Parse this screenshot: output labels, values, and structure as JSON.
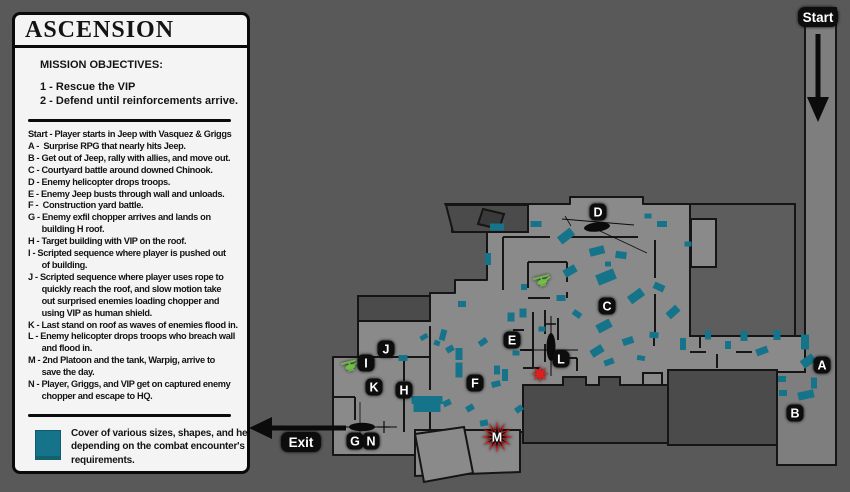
{
  "panel": {
    "title": "ASCENSION",
    "objectives_heading": "MISSION OBJECTIVES:",
    "objectives": [
      "1 - Rescue the VIP",
      "2 - Defend until reinforcements arrive."
    ],
    "mission_lines": [
      {
        "text": "Start - Player starts in Jeep with Vasquez & Griggs",
        "indent": 0
      },
      {
        "text": "A -  Surprise RPG that nearly hits Jeep.",
        "indent": 0
      },
      {
        "text": "B - Get out of Jeep, rally with allies, and move out.",
        "indent": 0
      },
      {
        "text": "C - Courtyard battle around downed Chinook.",
        "indent": 0
      },
      {
        "text": "D - Enemy helicopter drops troops.",
        "indent": 0
      },
      {
        "text": "E - Enemy Jeep busts through wall and unloads.",
        "indent": 0
      },
      {
        "text": "F -  Construction yard battle.",
        "indent": 0
      },
      {
        "text": "G - Enemy exfil chopper arrives and lands on",
        "indent": 0
      },
      {
        "text": "building H roof.",
        "indent": 1
      },
      {
        "text": "H - Target building with VIP on the roof.",
        "indent": 0
      },
      {
        "text": "I - Scripted sequence where player is pushed out",
        "indent": 0
      },
      {
        "text": "of building.",
        "indent": 1
      },
      {
        "text": "J - Scripted sequence where player uses rope to",
        "indent": 0
      },
      {
        "text": "quickly reach the roof, and slow motion take",
        "indent": 1
      },
      {
        "text": "out surprised enemies loading chopper and",
        "indent": 1
      },
      {
        "text": "using VIP as human shield.",
        "indent": 1
      },
      {
        "text": "K - Last stand on roof as waves of enemies flood in.",
        "indent": 0
      },
      {
        "text": "L - Enemy helicopter drops troops who breach wall",
        "indent": 0
      },
      {
        "text": "and flood in.",
        "indent": 1
      },
      {
        "text": "M - 2nd Platoon and the tank, Warpig, arrive to",
        "indent": 0
      },
      {
        "text": "save the day.",
        "indent": 1
      },
      {
        "text": "N - Player, Griggs, and VIP get on captured enemy",
        "indent": 0
      },
      {
        "text": "chopper and escape to HQ.",
        "indent": 1
      }
    ],
    "legend_note_lines": [
      "Cover of various sizes, shapes, and heights",
      "depending on the combat encounter's",
      "requirements."
    ],
    "legend_swatch_color": "#15748a"
  },
  "map": {
    "colors": {
      "bg": "#595959",
      "ground": "#8a8a8a",
      "road": "#7e7e7e",
      "cover": "#15748a",
      "dark_building": "#4b4b4b",
      "mid_building": "#5d5d5d",
      "darkest": "#3a3a3a",
      "wall": "#161616",
      "outline": "#151515",
      "marker_bg": "#0c0c0c",
      "marker_text": "#ffffff",
      "star_red": "#e51c1c",
      "heli_green": "#6fbe44",
      "heli_black": "#0b0b0b"
    },
    "road": {
      "pts": "805,8 836,8 836,465 777,465 777,372 805,372"
    },
    "ground": {
      "pts": "445,204 570,204 570,197 643,197 643,204 795,204 795,336 805,336 805,372 668,372 668,385 523,385 523,432 430,432 430,455 333,455 333,357 358,357 358,296 430,296 430,293 455,293 455,280 487,280 487,232 452,232 452,204"
    },
    "protrusion": {
      "pts": "415,430 520,430 520,472 415,476"
    },
    "tilted_square": {
      "pts": "415,434 464,427 473,473 424,482"
    },
    "buildings": [
      {
        "name": "building-top-band",
        "pts": "446,205 528,205 528,232 453,232",
        "fill": "dark"
      },
      {
        "name": "building-ramp",
        "pts": "483,209 504,214 499,229 478,224",
        "fill": "darkest"
      },
      {
        "name": "building-right-block",
        "pts": "690,204 795,204 795,336 690,336",
        "fill": "mid"
      },
      {
        "name": "building-right-room",
        "pts": "691,219 716,219 716,267 691,267",
        "fill": "ground"
      },
      {
        "name": "building-bottom-right",
        "pts": "668,370 777,370 777,445 668,445",
        "fill": "dark"
      },
      {
        "name": "building-bottom-center",
        "pts": "523,385 563,385 563,377 586,377 586,385 599,385 599,377 620,377 620,385 668,385 668,443 523,443",
        "fill": "dark"
      },
      {
        "name": "building-above-j",
        "pts": "358,296 430,296 430,321 358,321",
        "fill": "dark"
      },
      {
        "name": "small-room-passage",
        "pts": "643,373 662,373 662,385 643,385",
        "fill": "ground"
      }
    ],
    "walls": [
      [
        503,
        237,
        550,
        237
      ],
      [
        568,
        237,
        638,
        237
      ],
      [
        503,
        237,
        503,
        290
      ],
      [
        655,
        240,
        655,
        278
      ],
      [
        655,
        294,
        655,
        332
      ],
      [
        528,
        262,
        567,
        262
      ],
      [
        567,
        262,
        567,
        282
      ],
      [
        567,
        292,
        567,
        298
      ],
      [
        528,
        298,
        550,
        298
      ],
      [
        528,
        262,
        528,
        288
      ],
      [
        533,
        312,
        533,
        368
      ],
      [
        545,
        310,
        545,
        334
      ],
      [
        545,
        344,
        545,
        362
      ],
      [
        520,
        350,
        533,
        350
      ],
      [
        513,
        330,
        524,
        330
      ],
      [
        558,
        318,
        558,
        340
      ],
      [
        558,
        358,
        577,
        358
      ],
      [
        577,
        358,
        577,
        371
      ],
      [
        523,
        368,
        540,
        368
      ],
      [
        654,
        336,
        654,
        346
      ],
      [
        700,
        336,
        700,
        348
      ],
      [
        717,
        354,
        717,
        368
      ],
      [
        690,
        352,
        706,
        352
      ],
      [
        736,
        352,
        752,
        352
      ],
      [
        404,
        357,
        404,
        381
      ],
      [
        404,
        397,
        404,
        432
      ],
      [
        430,
        300,
        430,
        316
      ],
      [
        430,
        326,
        430,
        390
      ],
      [
        430,
        400,
        430,
        430
      ],
      [
        358,
        357,
        430,
        357
      ],
      [
        333,
        397,
        355,
        397
      ],
      [
        355,
        397,
        355,
        420
      ]
    ],
    "covers": [
      [
        497,
        227,
        14,
        7,
        0
      ],
      [
        536,
        224,
        11,
        6,
        0
      ],
      [
        566,
        236,
        16,
        9,
        -38
      ],
      [
        597,
        251,
        15,
        8,
        -14
      ],
      [
        621,
        255,
        11,
        7,
        8
      ],
      [
        662,
        224,
        10,
        6,
        0
      ],
      [
        648,
        216,
        7,
        5,
        0
      ],
      [
        688,
        244,
        7,
        5,
        0
      ],
      [
        570,
        271,
        13,
        8,
        -30
      ],
      [
        606,
        277,
        19,
        11,
        -22
      ],
      [
        636,
        296,
        16,
        9,
        -36
      ],
      [
        659,
        287,
        11,
        7,
        25
      ],
      [
        673,
        312,
        13,
        8,
        -42
      ],
      [
        604,
        326,
        15,
        9,
        -28
      ],
      [
        577,
        314,
        9,
        6,
        35
      ],
      [
        628,
        341,
        11,
        7,
        -18
      ],
      [
        654,
        335,
        9,
        6,
        5
      ],
      [
        597,
        351,
        13,
        8,
        -32
      ],
      [
        561,
        298,
        9,
        6,
        0
      ],
      [
        523,
        313,
        7,
        9,
        0
      ],
      [
        542,
        329,
        7,
        5,
        0
      ],
      [
        608,
        264,
        6,
        5,
        0
      ],
      [
        524,
        287,
        6,
        6,
        0
      ],
      [
        488,
        259,
        6,
        12,
        0
      ],
      [
        462,
        304,
        8,
        6,
        0
      ],
      [
        641,
        358,
        8,
        5,
        10
      ],
      [
        609,
        362,
        10,
        6,
        -20
      ],
      [
        511,
        317,
        7,
        9,
        0
      ],
      [
        516,
        353,
        7,
        5,
        0
      ],
      [
        443,
        335,
        6,
        11,
        15
      ],
      [
        450,
        349,
        8,
        6,
        -30
      ],
      [
        459,
        354,
        7,
        12,
        0
      ],
      [
        483,
        342,
        9,
        6,
        -35
      ],
      [
        459,
        370,
        7,
        15,
        0
      ],
      [
        497,
        370,
        6,
        9,
        0
      ],
      [
        505,
        375,
        6,
        12,
        0
      ],
      [
        447,
        403,
        8,
        6,
        -25
      ],
      [
        470,
        408,
        8,
        6,
        -30
      ],
      [
        484,
        423,
        8,
        6,
        -10
      ],
      [
        519,
        409,
        8,
        6,
        -35
      ],
      [
        403,
        358,
        9,
        6,
        0
      ],
      [
        424,
        337,
        8,
        5,
        -30
      ],
      [
        437,
        343,
        6,
        5,
        20
      ],
      [
        496,
        384,
        9,
        6,
        -15
      ],
      [
        427,
        400,
        31,
        8,
        0
      ],
      [
        427,
        408,
        27,
        8,
        0
      ],
      [
        683,
        344,
        6,
        12,
        0
      ],
      [
        708,
        335,
        6,
        9,
        0
      ],
      [
        728,
        345,
        6,
        8,
        0
      ],
      [
        744,
        336,
        7,
        10,
        0
      ],
      [
        762,
        351,
        12,
        7,
        -20
      ],
      [
        777,
        335,
        7,
        10,
        0
      ],
      [
        805,
        342,
        8,
        15,
        0
      ],
      [
        808,
        361,
        14,
        9,
        -35
      ],
      [
        814,
        383,
        6,
        11,
        0
      ],
      [
        806,
        395,
        16,
        8,
        -12
      ],
      [
        782,
        379,
        8,
        6,
        0
      ],
      [
        783,
        393,
        8,
        6,
        0
      ]
    ],
    "markers": [
      {
        "letter": "A",
        "x": 822,
        "y": 365
      },
      {
        "letter": "B",
        "x": 795,
        "y": 413
      },
      {
        "letter": "C",
        "x": 607,
        "y": 306
      },
      {
        "letter": "D",
        "x": 598,
        "y": 212
      },
      {
        "letter": "E",
        "x": 512,
        "y": 340
      },
      {
        "letter": "F",
        "x": 475,
        "y": 383
      },
      {
        "letter": "G",
        "x": 355,
        "y": 441
      },
      {
        "letter": "H",
        "x": 404,
        "y": 390
      },
      {
        "letter": "I",
        "x": 366,
        "y": 363
      },
      {
        "letter": "J",
        "x": 386,
        "y": 349
      },
      {
        "letter": "K",
        "x": 374,
        "y": 387
      },
      {
        "letter": "L",
        "x": 561,
        "y": 359
      },
      {
        "letter": "N",
        "x": 371,
        "y": 441
      }
    ],
    "explosion_marker": {
      "letter": "M",
      "x": 497,
      "y": 437
    },
    "stars": [
      {
        "x": 540,
        "y": 374
      }
    ],
    "pills": [
      {
        "text": "Start",
        "x": 818,
        "y": 17
      },
      {
        "text": "Exit",
        "x": 301,
        "y": 442
      }
    ],
    "green_helicopters": [
      {
        "x": 350,
        "y": 366,
        "rot": -15
      },
      {
        "x": 542,
        "y": 281,
        "rot": -15
      }
    ],
    "black_helicopters": {
      "topdown_vertical": {
        "x": 551,
        "y": 347
      },
      "topdown_horizontal": {
        "x": 362,
        "y": 427
      },
      "side_view": {
        "x": 597,
        "y": 227
      }
    }
  }
}
